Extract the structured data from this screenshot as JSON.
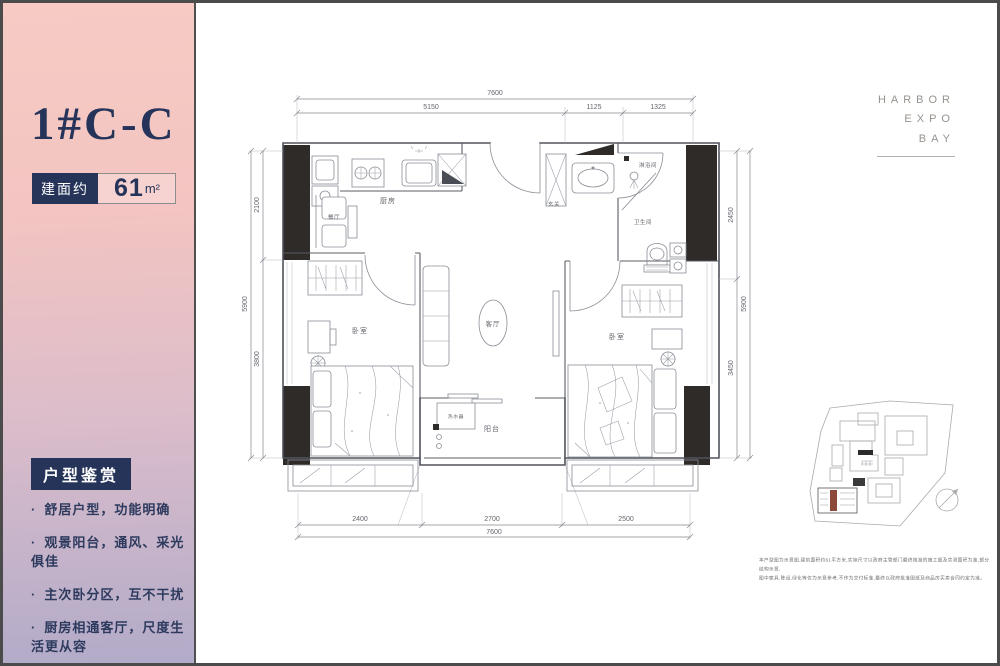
{
  "sidebar": {
    "unit_name": "1#C-C",
    "area_label": "建面约",
    "area_number": "61",
    "area_unit": "m²",
    "section_title": "户型鉴赏",
    "features": [
      "舒居户型，功能明确",
      "观景阳台，通风、采光俱佳",
      "主次卧分区，互不干扰",
      "厨房相通客厅，尺度生活更从容"
    ]
  },
  "brand": {
    "line1": "HARBOR",
    "line2": "EXPO",
    "line3": "BAY"
  },
  "floorplan": {
    "rooms": {
      "dining": "餐厅",
      "kitchen": "厨房",
      "entry": "玄关",
      "shower": "淋浴间",
      "bathroom": "卫生间",
      "living": "客厅",
      "bedroom_left": "卧室",
      "bedroom_right": "卧室",
      "water_heater": "热水器",
      "balcony": "阳台"
    },
    "dimensions": {
      "top_total": "7600",
      "top_segments": [
        "5150",
        "1125",
        "1325"
      ],
      "bottom_segments": [
        "2400",
        "2700",
        "2500"
      ],
      "bottom_total": "7600",
      "left_segments": [
        "2100",
        "3800"
      ],
      "left_total": "5900",
      "right_segments": [
        "2450",
        "3450"
      ],
      "right_total": "5900"
    }
  },
  "disclaimer": {
    "line1": "本户型图为示意图,建筑面积约61平方米,实际尺寸以政府主管部门最终核准的施工图及实测面积为准,部分结构示意,",
    "line2": "图中家具,陈设,绿化等仅为示意参考,不作为交付标准,最终以政府批准图纸及商品房买卖合同约定为准。"
  },
  "colors": {
    "accent_navy": "#26345a",
    "gradient_top": "#f7cbc4",
    "gradient_bottom": "#b2abc9",
    "highlight_brown": "#8d4a3a"
  }
}
